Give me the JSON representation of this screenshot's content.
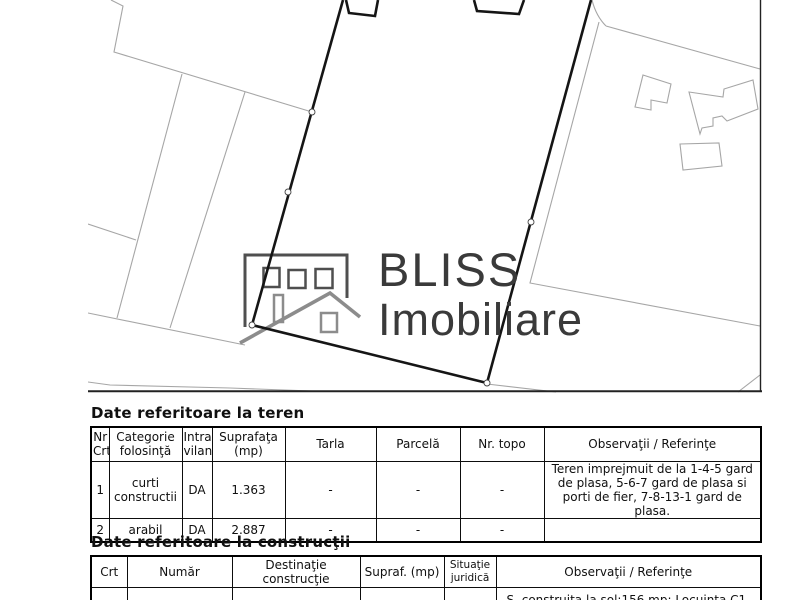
{
  "map": {
    "watermark": {
      "line1": "BLISS",
      "line2": "Imobiliare"
    },
    "colors": {
      "parcel": "#a6a6a6",
      "boundary": "#151515",
      "frame": "#222222",
      "marker_stroke": "#444444",
      "logo_dark": "#4f4f4f",
      "logo_light": "#8c8c8c",
      "logo_text": "#3a3a3a"
    }
  },
  "teren": {
    "title": "Date referitoare la teren",
    "headers": {
      "0": "Nr\nCrt",
      "1": "Categorie\nfolosinţă",
      "2": "Intra\nvilan",
      "3": "Suprafaţa\n(mp)",
      "4": "Tarla",
      "5": "Parcelă",
      "6": "Nr. topo",
      "7": "Observaţii / Referinţe"
    },
    "rows": [
      [
        "1",
        "curti\nconstructii",
        "DA",
        "1.363",
        "-",
        "-",
        "-",
        "Teren imprejmuit de la 1-4-5 gard de plasa, 5-6-7 gard de plasa si porti de fier, 7-8-13-1 gard de plasa."
      ],
      [
        "2",
        "arabil",
        "DA",
        "2.887",
        "-",
        "-",
        "-",
        ""
      ]
    ]
  },
  "constructii": {
    "title": "Date referitoare la construcţii",
    "headers": {
      "0": "Crt",
      "1": "Număr",
      "2": "Destinaţie\nconstrucţie",
      "3": "Supraf. (mp)",
      "4": "Situaţie\njuridică",
      "5": "Observaţii / Referinţe"
    },
    "rows": [
      [
        "",
        "",
        "constructii de",
        "",
        "",
        "S. construita la sol:156 mp;  Locuinta C1, nivel"
      ]
    ]
  }
}
